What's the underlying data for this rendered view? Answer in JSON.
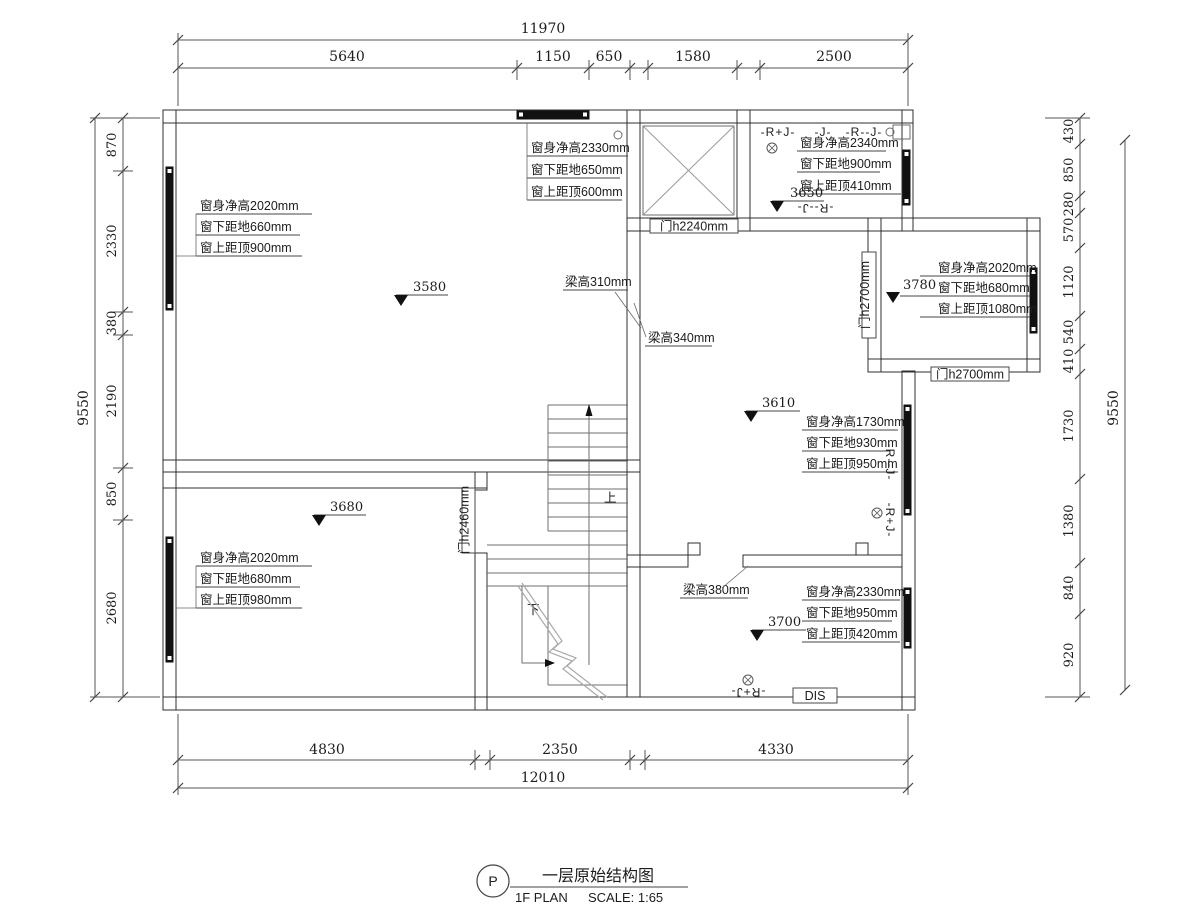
{
  "dimensions": {
    "top": {
      "total": "11970",
      "segments": [
        "5640",
        "1150",
        "650",
        "1580",
        "2500"
      ]
    },
    "bottom": {
      "total": "12010",
      "segments": [
        "4830",
        "2350",
        "4330"
      ]
    },
    "left": {
      "total": "9550",
      "segments": [
        "870",
        "2330",
        "380",
        "2190",
        "850",
        "2680"
      ]
    },
    "right": {
      "total": "9550",
      "segments": [
        "430",
        "850",
        "280",
        "570",
        "1120",
        "540",
        "410",
        "1730",
        "1380",
        "840",
        "920"
      ]
    }
  },
  "levels": {
    "room_top_left": "3580",
    "room_top_right": "3650",
    "room_right": "3780",
    "living": "3610",
    "room_bottom_left": "3680",
    "room_bottom_right": "3700"
  },
  "window_notes": {
    "top_left": [
      "窗身净高2020mm",
      "窗下距地660mm",
      "窗上距顶900mm"
    ],
    "top_middle": [
      "窗身净高2330mm",
      "窗下距地650mm",
      "窗上距顶600mm"
    ],
    "top_right": [
      "窗身净高2340mm",
      "窗下距地900mm",
      "窗上距顶410mm"
    ],
    "right_room": [
      "窗身净高2020mm",
      "窗下距地680mm",
      "窗上距顶1080mm"
    ],
    "living_room": [
      "窗身净高1730mm",
      "窗下距地930mm",
      "窗上距顶950mm"
    ],
    "bottom_left": [
      "窗身净高2020mm",
      "窗下距地680mm",
      "窗上距顶980mm"
    ],
    "bottom_right": [
      "窗身净高2330mm",
      "窗下距地950mm",
      "窗上距顶420mm"
    ]
  },
  "doors": {
    "shaft": "门h2240mm",
    "right_room_side": "门h2700mm",
    "right_room_bottom": "门h2700mm",
    "bottom_left_room": "门h2460mm"
  },
  "beams": {
    "b310": "梁高310mm",
    "b340": "梁高340mm",
    "b380": "梁高380mm"
  },
  "marks": {
    "rj_top_1": "-R+J-",
    "rj_top_2": "-J-",
    "rj_top_3": "-R--J-",
    "rj_top_4": "-R--J-",
    "rj_right_1": "-R--J-",
    "rj_right_2": "-R+J-",
    "rj_bottom": "-R+J-",
    "dis": "DIS"
  },
  "stairs": {
    "up": "上",
    "down": "下"
  },
  "title_block": {
    "tag": "P",
    "title_cn": "一层原始结构图",
    "title_en": "1F PLAN",
    "scale_label": "SCALE: 1:65"
  }
}
